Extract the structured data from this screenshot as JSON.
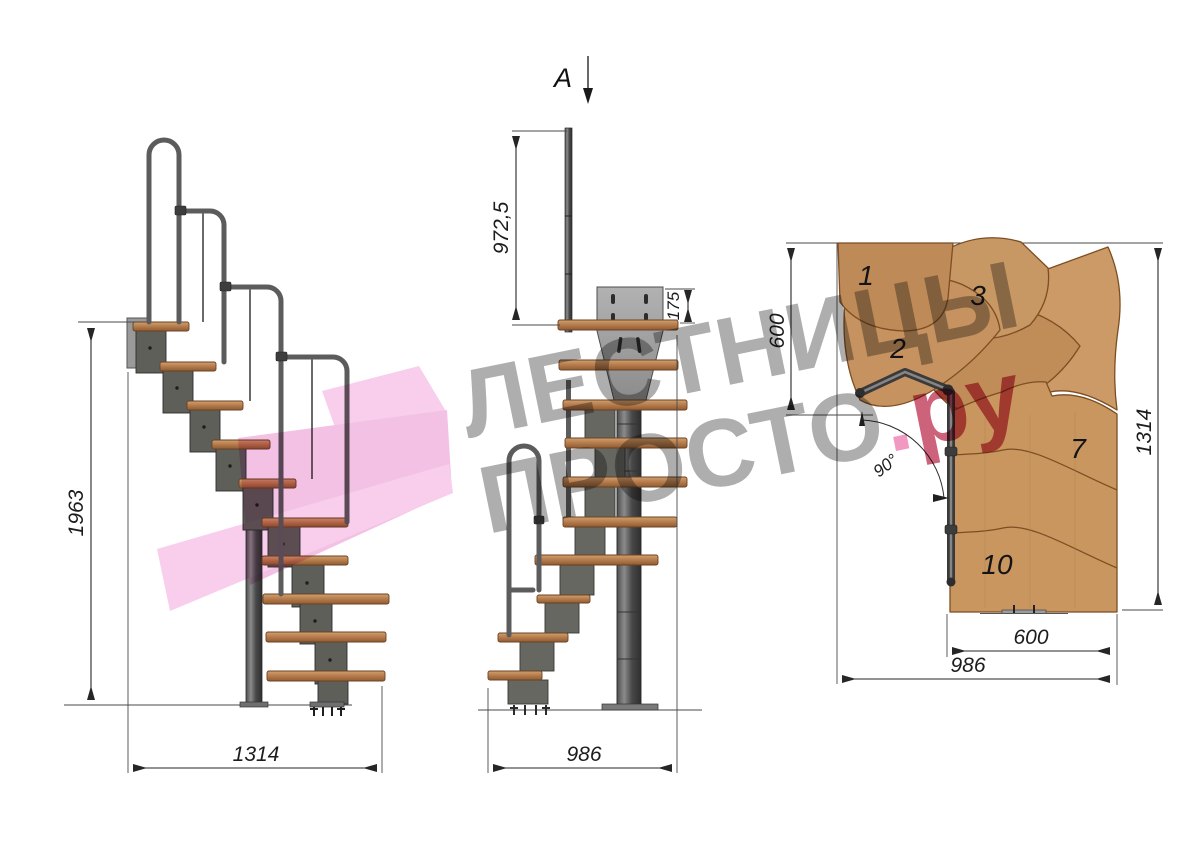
{
  "section_marker": {
    "label": "A"
  },
  "side_view": {
    "total_height": "1963",
    "total_length": "1314"
  },
  "front_view": {
    "handrail_height": "972,5",
    "mount_plate_height": "175",
    "total_width": "986"
  },
  "plan_view": {
    "landing_depth": "600",
    "total_length": "1314",
    "flight_width": "600",
    "total_width": "986",
    "turn_angle": "90°",
    "step_numbers": [
      "1",
      "2",
      "3",
      "7",
      "10"
    ]
  },
  "watermark": {
    "line1": "ЛЕСТНИЦЫ",
    "line2": "ПРОСТО",
    "dot": ".",
    "suffix": "ру"
  },
  "colors": {
    "wood": "#c6935f",
    "wood_outline": "#7c4e22",
    "metal": "#5a5a5a",
    "metal_dark": "#343434",
    "mount_plate": "#a3a3a3",
    "dimension_line": "#262626",
    "watermark_gray": "#9c9c9c",
    "watermark_pink_dot": "#ee82b4",
    "watermark_red": "#c23f5e",
    "ribbon_pink": "#f3aee0"
  }
}
